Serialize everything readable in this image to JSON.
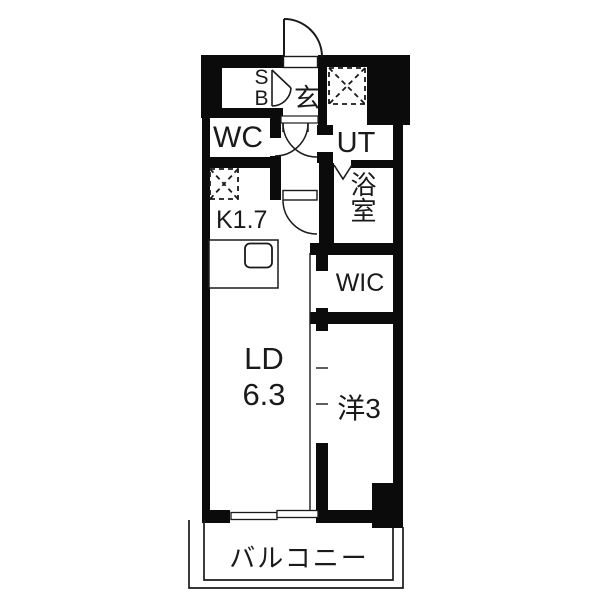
{
  "floor_plan": {
    "type": "apartment-floor-plan",
    "colors": {
      "wall": "#0b0b0b",
      "background": "#ffffff",
      "line": "#1a1a1a"
    },
    "labels": {
      "entrance": "玄",
      "shoe_box": "SB",
      "wc": "WC",
      "utility": "UT",
      "bathroom": "浴室",
      "kitchen": "K1.7",
      "wic": "WIC",
      "living_dining_line1": "LD",
      "living_dining_line2": "6.3",
      "western_room": "洋3",
      "balcony": "バルコニー"
    },
    "symbols": [
      "entrance-door-swing",
      "shoe-box-folding-door",
      "hall-double-door-swing",
      "kitchen-door-swing",
      "bathroom-folding-door",
      "washing-machine-space",
      "refrigerator-space",
      "kitchen-counter-sink",
      "sliding-partition",
      "sliding-window",
      "balcony-railing"
    ]
  }
}
